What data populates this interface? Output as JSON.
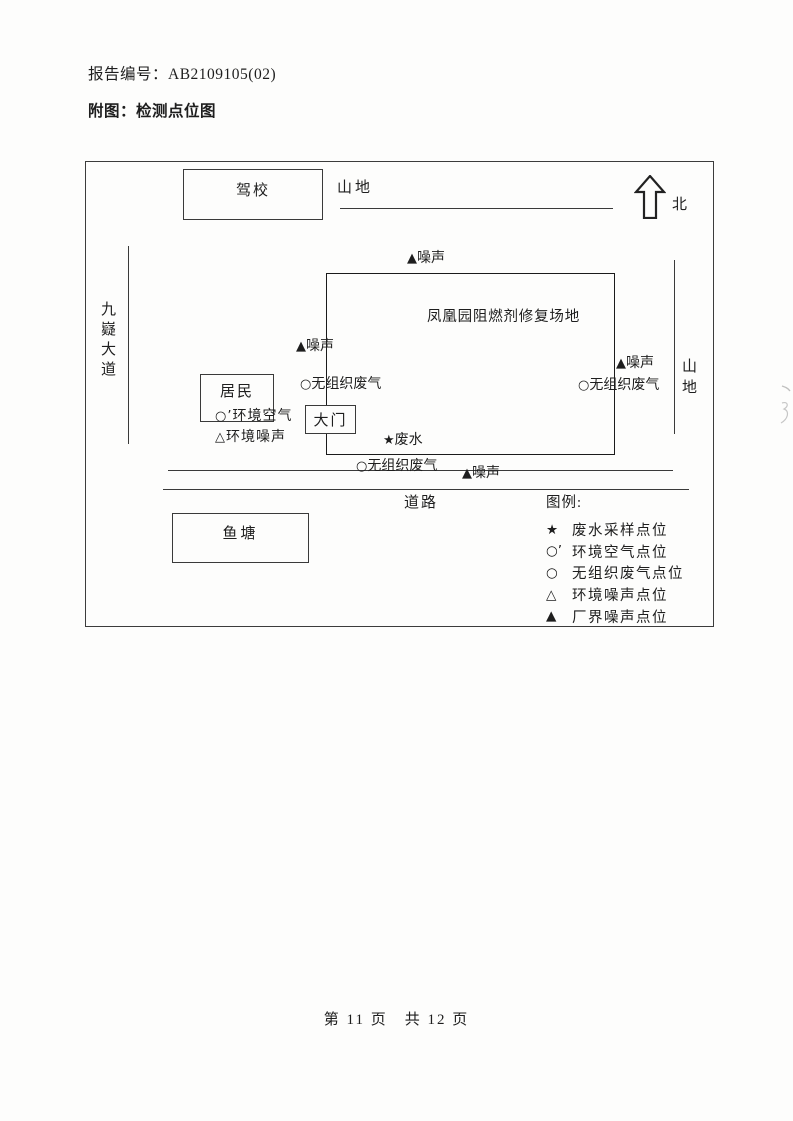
{
  "page": {
    "report_label": "报告编号：AB2109105(02)",
    "figure_label": "附图：检测点位图",
    "footer": "第 11 页　共 12 页"
  },
  "diagram": {
    "north": "北",
    "site_label": "凤凰园阻燃剂修复场地",
    "areas": {
      "driving_school": "驾校",
      "mountain_top": "山地",
      "mountain_right": "山地",
      "avenue": "九嶷大道",
      "residents": "居民",
      "gate": "大门",
      "fish_pond": "鱼塘",
      "road": "道路"
    },
    "markers": {
      "noise_top": {
        "sym": "▲",
        "label": "噪声"
      },
      "noise_left": {
        "sym": "▲",
        "label": "噪声"
      },
      "noise_right": {
        "sym": "▲",
        "label": "噪声"
      },
      "noise_road": {
        "sym": "▲",
        "label": "噪声"
      },
      "gas_left": {
        "sym": "○",
        "label": "无组织废气"
      },
      "gas_right": {
        "sym": "○",
        "label": "无组织废气"
      },
      "gas_bottom": {
        "sym": "○",
        "label": "无组织废气"
      },
      "wastewater": {
        "sym": "★",
        "label": "废水"
      },
      "ambient_air": {
        "sym": "○’",
        "label": "环境空气"
      },
      "env_noise": {
        "sym": "△",
        "label": "环境噪声"
      }
    },
    "legend": {
      "title": "图例:",
      "items": [
        {
          "sym": "★",
          "label": "废水采样点位"
        },
        {
          "sym": "○’",
          "label": "环境空气点位"
        },
        {
          "sym": "○",
          "label": "无组织废气点位"
        },
        {
          "sym": "△",
          "label": "环境噪声点位"
        },
        {
          "sym": "▲",
          "label": "厂界噪声点位"
        }
      ]
    }
  }
}
